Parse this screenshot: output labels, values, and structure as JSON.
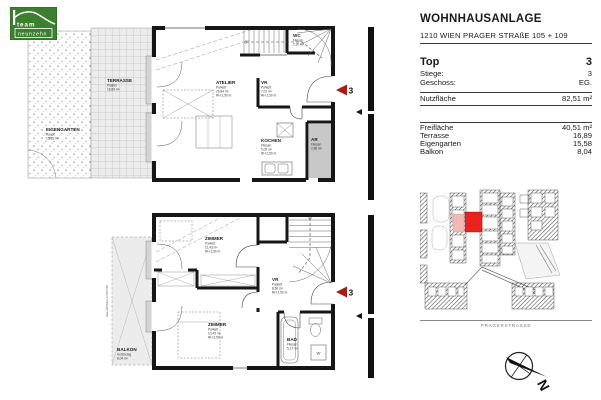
{
  "logo": {
    "line1": "team",
    "line2": "neunzehn"
  },
  "header": {
    "title": "WOHNHAUSANLAGE",
    "subtitle": "1210 WIEN PRAGER STRAßE 105 + 109"
  },
  "unit": {
    "top_label": "Top",
    "top_value": "3",
    "stiege_label": "Stiege:",
    "stiege_value": "3",
    "geschoss_label": "Geschoss:",
    "geschoss_value": "EG."
  },
  "areas": {
    "nutzflaeche_label": "Nutzfläche",
    "nutzflaeche_value": "82,51 m²",
    "freiflaeche_label": "Freifläche",
    "freiflaeche_value": "40,51 m²",
    "terrasse_label": "Terrasse",
    "terrasse_value": "16,89",
    "eigengarten_label": "Eigengarten",
    "eigengarten_value": "15,58",
    "balkon_label": "Balkon",
    "balkon_value": "8,04"
  },
  "site": {
    "street_label": "PRAGERSTRASSE",
    "compass_label": "N"
  },
  "plans": {
    "upper": {
      "terrasse": {
        "name": "TERRASSE",
        "material": "Platten",
        "area": "16,89 m²"
      },
      "eigengarten": {
        "name": "EIGENGARTEN",
        "material": "Rasen",
        "area": "15,58 m²"
      },
      "atelier": {
        "name": "ATELIER",
        "material": "Parkett",
        "area": "29,84 m²",
        "height": "RH 2,50 m"
      },
      "vr": {
        "name": "VR",
        "material": "Parkett",
        "area": "7,01 m²",
        "height": "RH 2,50 m"
      },
      "wc": {
        "name": "WC",
        "material": "Fliesen",
        "area": "2,20 m²",
        "height": "RH 2,50 m"
      },
      "kochen": {
        "name": "KOCHEN",
        "material": "Fliesen",
        "area": "5,05 m²",
        "height": "RH 2,50 m"
      },
      "ar": {
        "name": "AR",
        "material": "Fliesen",
        "area": "2,86 m²",
        "height": "RH 2,50 m"
      },
      "marker": "3"
    },
    "lower": {
      "zimmer1": {
        "name": "ZIMMER",
        "material": "Parkett",
        "area": "11,43 m²",
        "height": "RH 2,50 m"
      },
      "vr": {
        "name": "VR",
        "material": "Parkett",
        "area": "8,50 m²",
        "height": "RH 2,50 m"
      },
      "zimmer2": {
        "name": "ZIMMER",
        "material": "Parkett",
        "area": "10,45 m²",
        "height": "RH 2,50 m"
      },
      "bad": {
        "name": "BAD",
        "material": "Fliesen",
        "area": "5,17 m²",
        "height": "RH 2,50 m"
      },
      "balkon": {
        "name": "BALKON",
        "material": "Holzbelag",
        "area": "8,04 m²"
      },
      "railing": "GELÄNDER H=100 CM",
      "washer": "W",
      "marker": "3"
    }
  },
  "colors": {
    "wall": "#161616",
    "logo_green": "#3c7f2f",
    "marker_red": "#a91b17",
    "site_unit_red": "#e8231e",
    "site_unit_pink": "#f2b8b2",
    "ar_gray": "#c8c8c8",
    "balcony_gray": "#ececec"
  }
}
